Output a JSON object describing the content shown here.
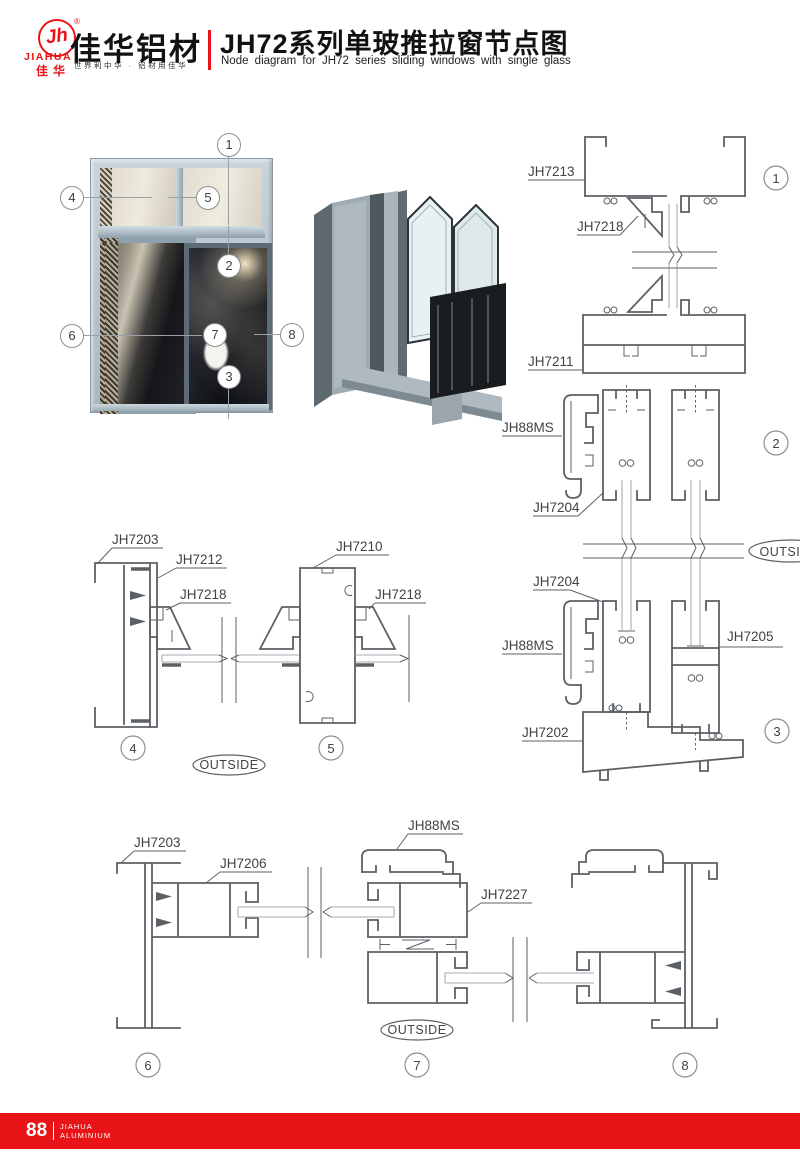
{
  "header": {
    "logo_monogram": "Jh",
    "logo_reg": "®",
    "logo_en": "JIAHUA",
    "logo_cn": "佳华",
    "brand_title": "佳华铝材",
    "brand_tagline": "世界利中华 · 铝材用佳华",
    "title_cn": "JH72系列单玻推拉窗节点图",
    "title_en": "Node diagram for JH72 series sliding windows with single glass"
  },
  "callouts": {
    "c1": "1",
    "c2": "2",
    "c3": "3",
    "c4": "4",
    "c5": "5",
    "c6": "6",
    "c7": "7",
    "c8": "8"
  },
  "labels": {
    "jh7213": "JH7213",
    "jh7218": "JH7218",
    "jh7211": "JH7211",
    "jh88ms": "JH88MS",
    "jh7204": "JH7204",
    "jh7205": "JH7205",
    "jh7202": "JH7202",
    "jh7203": "JH7203",
    "jh7212": "JH7212",
    "jh7210": "JH7210",
    "jh7206": "JH7206",
    "jh7227": "JH7227",
    "outside": "OUTSIDE"
  },
  "footer": {
    "page_number": "88",
    "brand_line1": "JIAHUA",
    "brand_line2": "ALUMINIUM"
  },
  "colors": {
    "accent_red": "#e81417",
    "line_gray": "#5c6166",
    "frame_blue": "#b7c4cd"
  }
}
